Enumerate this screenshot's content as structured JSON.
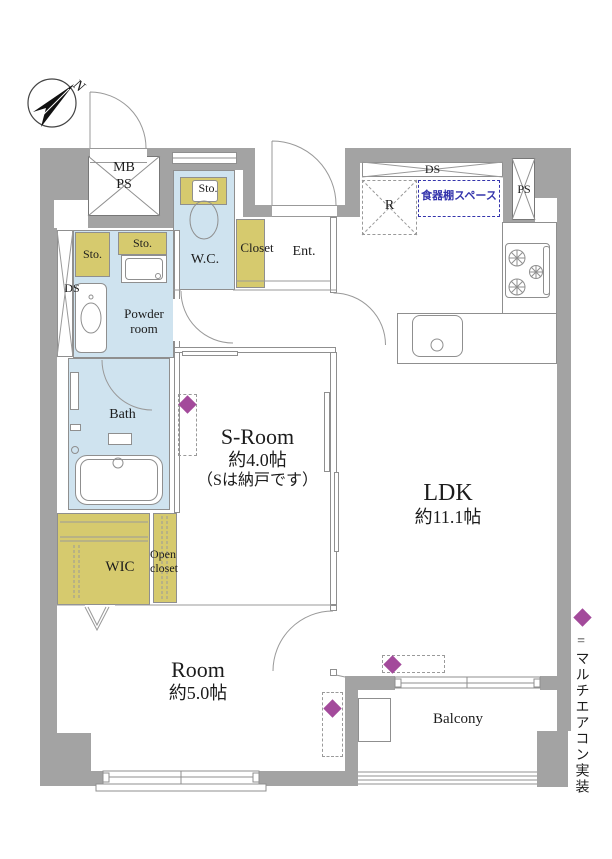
{
  "compass": {
    "label": "N"
  },
  "legend": {
    "text": "=マルチエアコン実装"
  },
  "colors": {
    "wall": "#a3a3a3",
    "wet_room": "#cfe3ef",
    "storage": "#d6ca6e",
    "aircon_diamond": "#a34a9b",
    "dish_shelf_blue": "#3434ac"
  },
  "rooms": {
    "meter_box": {
      "line1": "MB",
      "line2": "PS"
    },
    "pipe_space": "PS",
    "duct_top": "DS",
    "duct_left": "DS",
    "refrigerator": "R",
    "dish_shelf": "食器棚スペース",
    "storage_wc": "Sto.",
    "storage_a": "Sto.",
    "storage_b": "Sto.",
    "wc": "W.C.",
    "closet": "Closet",
    "entrance": "Ent.",
    "powder": {
      "line1": "Powder",
      "line2": "room"
    },
    "bath": "Bath",
    "service_room": {
      "line1": "S-Room",
      "line2": "約4.0帖",
      "line3": "（Sは納戸です）"
    },
    "ldk": {
      "line1": "LDK",
      "line2": "約11.1帖"
    },
    "wic": "WIC",
    "open_closet": {
      "line1": "Open",
      "line2": "closet"
    },
    "bedroom": {
      "line1": "Room",
      "line2": "約5.0帖"
    },
    "balcony": "Balcony"
  }
}
